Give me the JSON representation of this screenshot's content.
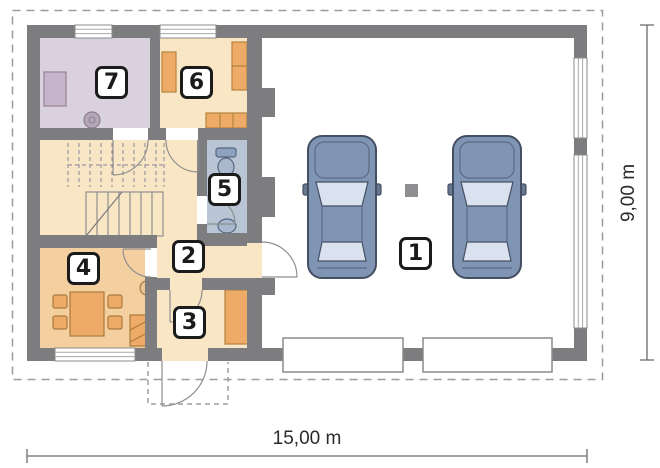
{
  "dimensions": {
    "width_label": "15,00 m",
    "height_label": "9,00 m"
  },
  "rooms": [
    {
      "number": "1"
    },
    {
      "number": "2"
    },
    {
      "number": "3"
    },
    {
      "number": "4"
    },
    {
      "number": "5"
    },
    {
      "number": "6"
    },
    {
      "number": "7"
    }
  ],
  "icons": {
    "toilet": "toilet-icon",
    "washbasin": "sink-icon",
    "bathroom_sink": "sink-icon",
    "car": "car-top-view-icon",
    "stairs": "stairs-icon",
    "table": "dining-table-icon",
    "wardrobe": "wardrobe-icon"
  },
  "colors": {
    "wall": "#7d7d7f",
    "room_cream": "#f9e6c5",
    "room_kitchen": "#f4cf9f",
    "room_utility": "#d9d1de",
    "room_bath": "#b9c5d4",
    "garage_floor": "#ffffff",
    "furniture": "#eeab68",
    "car_body": "#8094b4",
    "car_glass": "#d9e2ee",
    "dimension_line": "#6a6a6a",
    "dashed_outline": "#9a9aa0"
  }
}
